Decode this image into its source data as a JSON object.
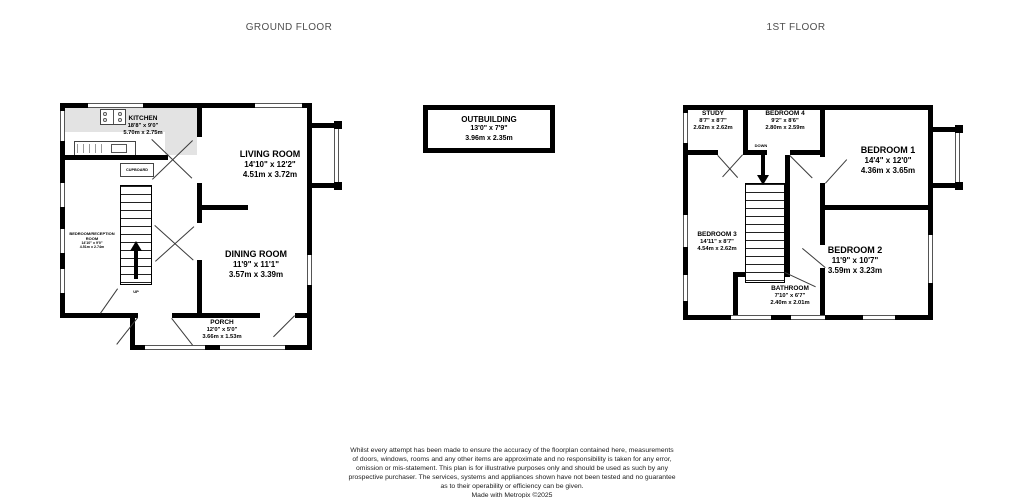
{
  "titles": {
    "ground_floor": "GROUND FLOOR",
    "first_floor": "1ST FLOOR"
  },
  "ground_floor": {
    "kitchen": {
      "name": "KITCHEN",
      "imperial": "18'8\" x 9'0\"",
      "metric": "5.70m x 2.75m"
    },
    "living_room": {
      "name": "LIVING ROOM",
      "imperial": "14'10\" x 12'2\"",
      "metric": "4.51m x 3.72m"
    },
    "dining_room": {
      "name": "DINING ROOM",
      "imperial": "11'9\" x 11'1\"",
      "metric": "3.57m x 3.39m"
    },
    "bedroom_reception": {
      "name": "BEDROOM/RECEPTION ROOM",
      "imperial": "14'10\" x 9'0\"",
      "metric": "4.51m x 2.74m"
    },
    "porch": {
      "name": "PORCH",
      "imperial": "12'0\" x 5'0\"",
      "metric": "3.66m x 1.53m"
    },
    "cupboard_label": "CUPBOARD",
    "up_label": "UP"
  },
  "outbuilding": {
    "name": "OUTBUILDING",
    "imperial": "13'0\" x 7'9\"",
    "metric": "3.96m x 2.35m"
  },
  "first_floor": {
    "study": {
      "name": "STUDY",
      "imperial": "8'7\" x 8'7\"",
      "metric": "2.62m x 2.62m"
    },
    "bedroom_4": {
      "name": "BEDROOM 4",
      "imperial": "9'2\" x 8'6\"",
      "metric": "2.80m x 2.59m"
    },
    "bedroom_1": {
      "name": "BEDROOM 1",
      "imperial": "14'4\" x 12'0\"",
      "metric": "4.36m x 3.65m"
    },
    "bedroom_3": {
      "name": "BEDROOM 3",
      "imperial": "14'11\" x 8'7\"",
      "metric": "4.54m x 2.62m"
    },
    "bathroom": {
      "name": "BATHROOM",
      "imperial": "7'10\" x 6'7\"",
      "metric": "2.40m x 2.01m"
    },
    "bedroom_2": {
      "name": "BEDROOM 2",
      "imperial": "11'9\" x 10'7\"",
      "metric": "3.59m x 3.23m"
    },
    "down_label": "DOWN"
  },
  "disclaimer": {
    "lines": [
      "Whilst every attempt has been made to ensure the accuracy of the floorplan contained here, measurements",
      "of doors, windows, rooms and any other items are approximate and no responsibility is taken for any error,",
      "omission or mis-statement. This plan is for illustrative purposes only and should be used as such by any",
      "prospective purchaser. The services, systems and appliances shown have not been tested and no guarantee",
      "as to their operability or efficiency can be given."
    ],
    "credit": "Made with Metropix ©2025"
  }
}
